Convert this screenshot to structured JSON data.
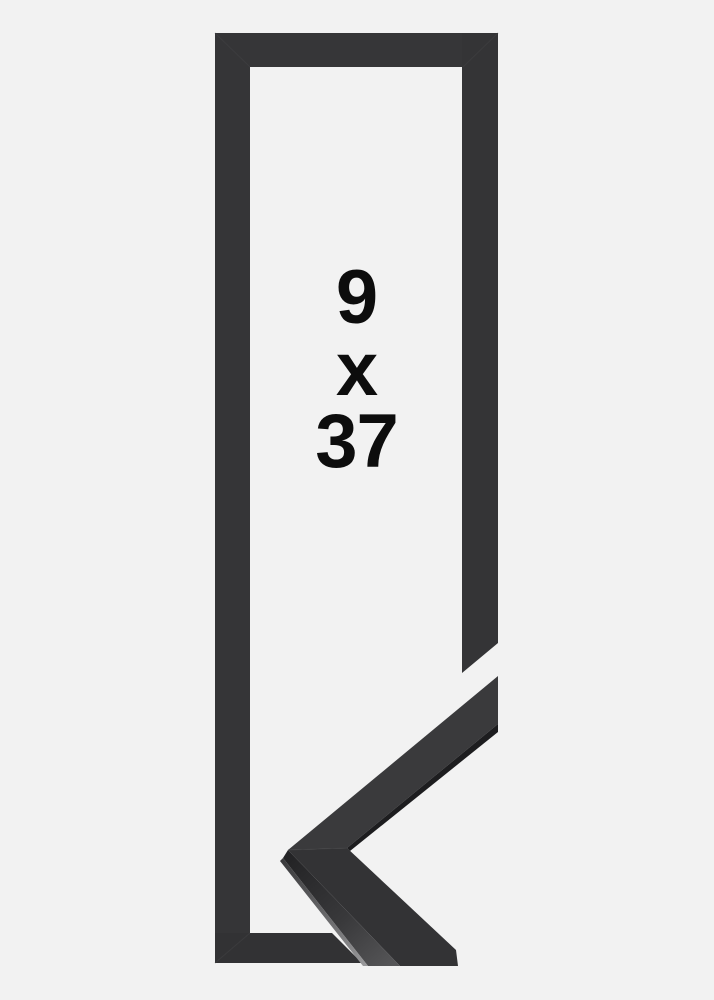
{
  "size_label": {
    "width_value": "9",
    "separator": "x",
    "height_value": "37"
  },
  "colors": {
    "background": "#f2f2f2",
    "frame_top_bar": "#363638",
    "frame_left_bar": "#353537",
    "frame_right_bar": "#343436",
    "frame_bottom_bar": "#323234",
    "sample_upper_arm_face": "#3a3a3c",
    "sample_under_lip": "#1d1d1f",
    "sample_lower_arm_face": "#333335",
    "text": "#0d0d0d"
  }
}
